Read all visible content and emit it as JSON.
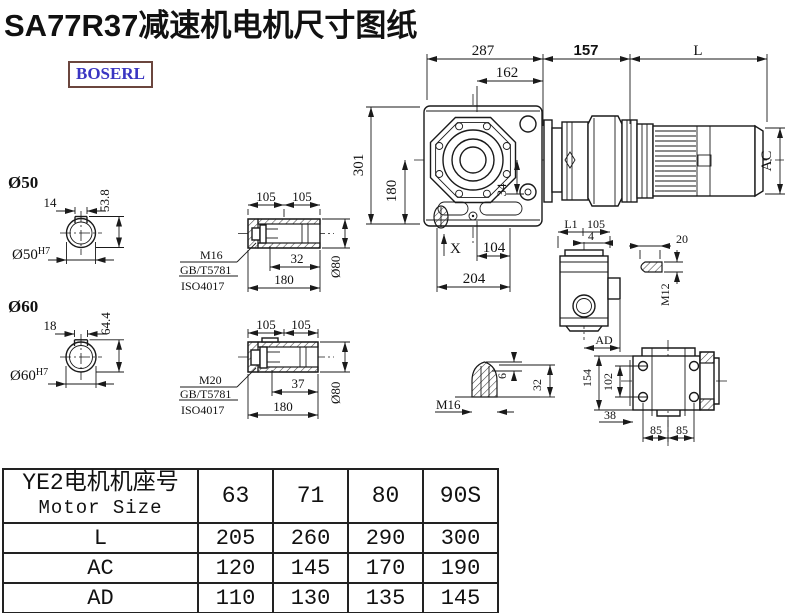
{
  "title": "SA77R37减速机电机尺寸图纸",
  "logo": "BOSERL",
  "colors": {
    "line": "#1a1a1a",
    "logo_text": "#3a35c2",
    "logo_border": "#6b463e"
  },
  "main_view": {
    "top_width": "287",
    "flange_width": "162",
    "adapter_len": "157",
    "motor_len": "L",
    "motor_dia": "AC",
    "total_height": "301",
    "axis_height": "180",
    "offset_34": "34",
    "label_x": "X",
    "bottom_104": "104",
    "bottom_204": "204"
  },
  "shaft_a": {
    "dia": "Ø50",
    "key_w": "14",
    "key_h": "53.8",
    "bore": "Ø50",
    "tol": "H7"
  },
  "shaft_b": {
    "dia": "Ø60",
    "key_w": "18",
    "key_h": "64.4",
    "bore": "Ø60",
    "tol": "H7"
  },
  "hollow_a": {
    "half1": "105",
    "half2": "105",
    "bolt_len": "32",
    "total": "180",
    "dia": "Ø80",
    "thread": "M16",
    "std1": "GB/T5781",
    "std2": "ISO4017"
  },
  "hollow_b": {
    "half1": "105",
    "half2": "105",
    "bolt_len": "37",
    "total": "180",
    "dia": "Ø80",
    "thread": "M20",
    "std1": "GB/T5781",
    "std2": "ISO4017"
  },
  "side_view": {
    "l1": "L1",
    "d105": "105",
    "d4": "4",
    "ad": "AD"
  },
  "key_detail": {
    "len": "20",
    "thread": "M12"
  },
  "plug_detail": {
    "cap": "6",
    "len": "32",
    "thread": "M16"
  },
  "face_view": {
    "height": "154",
    "hole_span": "102",
    "offset": "38",
    "pitch1": "85",
    "pitch2": "85"
  },
  "table": {
    "header_line1": "YE2电机机座号",
    "header_line2": "Motor Size",
    "columns": [
      "63",
      "71",
      "80",
      "90S"
    ],
    "rows": [
      {
        "label": "L",
        "values": [
          "205",
          "260",
          "290",
          "300"
        ]
      },
      {
        "label": "AC",
        "values": [
          "120",
          "145",
          "170",
          "190"
        ]
      },
      {
        "label": "AD",
        "values": [
          "110",
          "130",
          "135",
          "145"
        ]
      }
    ]
  }
}
